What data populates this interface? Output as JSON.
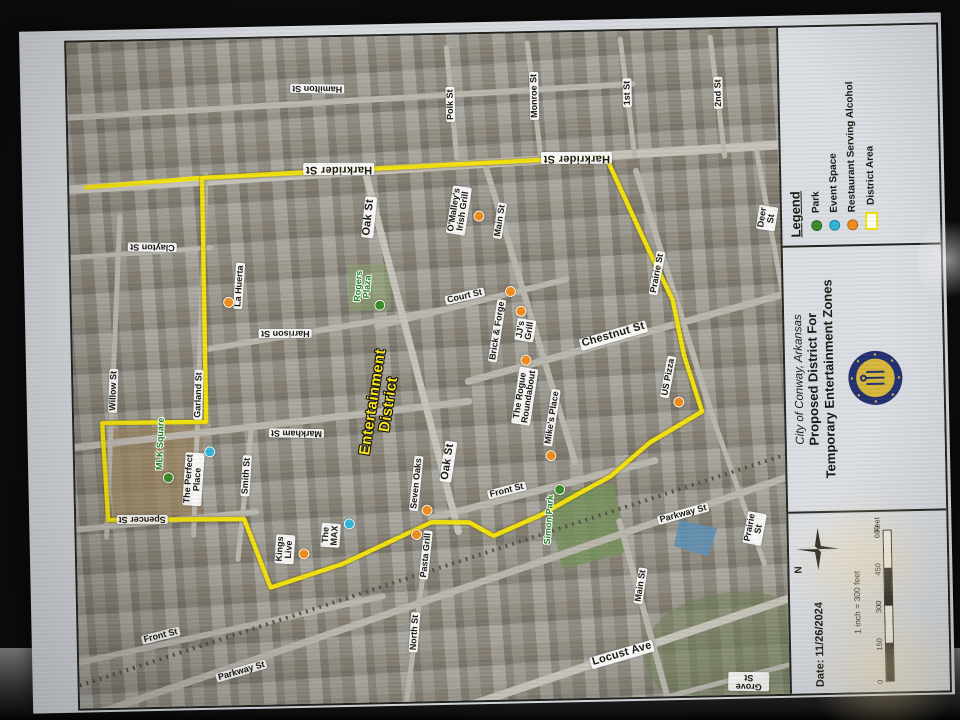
{
  "legend": {
    "title": "Legend",
    "items": [
      {
        "label": "Park",
        "swatch": "dot",
        "color": "#3a8b28"
      },
      {
        "label": "Event Space",
        "swatch": "dot",
        "color": "#2fb4d8"
      },
      {
        "label": "Restaurant Serving Alcohol",
        "swatch": "dot",
        "color": "#ef8c1a"
      },
      {
        "label": "District Area",
        "swatch": "box",
        "color": "#f3e20c"
      }
    ]
  },
  "title_block": {
    "city": "City of Conway, Arkansas",
    "line1": "Proposed District For",
    "line2": "Temporary Entertainment Zones"
  },
  "info_block": {
    "north_label": "N",
    "date": "Date: 11/26/2024",
    "scale_text": "1 inch = 300 feet",
    "scale_ticks": [
      "0",
      "150",
      "300",
      "450",
      "600"
    ],
    "scale_unit": "Feet"
  },
  "map": {
    "colors": {
      "boundary": "#f3e20c",
      "park": "#3a8b28",
      "event": "#2fb4d8",
      "restaurant": "#ef8c1a"
    },
    "district_label": {
      "t": "Entertainment\nDistrict",
      "x": 382,
      "y": 392,
      "r": -80
    },
    "district_polygon": [
      [
        208,
        163
      ],
      [
        612,
        150
      ],
      [
        652,
        242
      ],
      [
        676,
        295
      ],
      [
        686,
        350
      ],
      [
        703,
        407
      ],
      [
        650,
        437
      ],
      [
        610,
        470
      ],
      [
        575,
        488
      ],
      [
        540,
        507
      ],
      [
        492,
        527
      ],
      [
        468,
        513
      ],
      [
        430,
        512
      ],
      [
        340,
        552
      ],
      [
        268,
        574
      ],
      [
        243,
        505
      ],
      [
        107,
        503
      ],
      [
        103,
        406
      ],
      [
        207,
        407
      ]
    ],
    "district_stub": [
      [
        92,
        170
      ],
      [
        208,
        163
      ]
    ],
    "streets": [
      {
        "t": "Hamilton St",
        "x": 325,
        "y": 76,
        "r": 182
      },
      {
        "t": "Polk St",
        "x": 458,
        "y": 95,
        "r": -90
      },
      {
        "t": "Monroe St",
        "x": 542,
        "y": 88,
        "r": -90
      },
      {
        "t": "1st St",
        "x": 635,
        "y": 87,
        "r": -90
      },
      {
        "t": "2nd St",
        "x": 726,
        "y": 89,
        "r": -90
      },
      {
        "t": "Harkrider St",
        "x": 345,
        "y": 157,
        "r": 181,
        "big": true
      },
      {
        "t": "Harkrider St",
        "x": 583,
        "y": 151,
        "r": 181,
        "big": true
      },
      {
        "t": "Clayton St",
        "x": 157,
        "y": 231,
        "r": 182
      },
      {
        "t": "Oak St",
        "x": 374,
        "y": 206,
        "r": -83,
        "big": true
      },
      {
        "t": "Deer St",
        "x": 772,
        "y": 215,
        "r": -80
      },
      {
        "t": "Main St",
        "x": 505,
        "y": 212,
        "r": -80
      },
      {
        "t": "Prairie St",
        "x": 661,
        "y": 268,
        "r": -78
      },
      {
        "t": "Court St",
        "x": 468,
        "y": 287,
        "r": -12
      },
      {
        "t": "Harrison St",
        "x": 288,
        "y": 320,
        "r": 181
      },
      {
        "t": "Chestnut St",
        "x": 616,
        "y": 329,
        "r": -15,
        "big": true
      },
      {
        "t": "Willow St",
        "x": 115,
        "y": 374,
        "r": -87
      },
      {
        "t": "Garland St",
        "x": 200,
        "y": 380,
        "r": -87
      },
      {
        "t": "Markham St",
        "x": 297,
        "y": 420,
        "r": 182
      },
      {
        "t": "Oak St",
        "x": 448,
        "y": 452,
        "r": -80,
        "big": true
      },
      {
        "t": "Smith St",
        "x": 246,
        "y": 462,
        "r": -85
      },
      {
        "t": "Spencer St",
        "x": 141,
        "y": 503,
        "r": 181
      },
      {
        "t": "Front St",
        "x": 506,
        "y": 482,
        "r": -13
      },
      {
        "t": "Parkway St",
        "x": 682,
        "y": 509,
        "r": -14
      },
      {
        "t": "Prairie St",
        "x": 753,
        "y": 525,
        "r": -78
      },
      {
        "t": "Front St",
        "x": 157,
        "y": 620,
        "r": -13
      },
      {
        "t": "North St",
        "x": 411,
        "y": 622,
        "r": -85
      },
      {
        "t": "Main St",
        "x": 638,
        "y": 580,
        "r": -80
      },
      {
        "t": "Parkway St",
        "x": 237,
        "y": 657,
        "r": -15
      },
      {
        "t": "Locust Ave",
        "x": 618,
        "y": 648,
        "r": -15,
        "big": true
      },
      {
        "t": "Grove St",
        "x": 744,
        "y": 678,
        "r": 182
      }
    ],
    "pois": [
      {
        "t": "La Huerta",
        "x": 243,
        "y": 272,
        "r": -85,
        "c": "restaurant",
        "dx": 232,
        "dy": 288
      },
      {
        "t": "Rogers\nPlaza",
        "x": 367,
        "y": 275,
        "r": -85,
        "c": "park",
        "dx": 383,
        "dy": 294
      },
      {
        "t": "O'Malley's\nIrish Grill",
        "x": 464,
        "y": 201,
        "r": -80,
        "c": "restaurant",
        "dx": 484,
        "dy": 207
      },
      {
        "t": "Brick & Forge",
        "x": 500,
        "y": 322,
        "r": -80,
        "c": "restaurant",
        "dx": 514,
        "dy": 283
      },
      {
        "t": "JJ's\nGrill",
        "x": 528,
        "y": 322,
        "r": -80,
        "c": "restaurant",
        "dx": 524,
        "dy": 303
      },
      {
        "t": "The Rogue\nRoundabout",
        "x": 526,
        "y": 388,
        "r": -80,
        "c": "restaurant",
        "dx": 528,
        "dy": 352
      },
      {
        "t": "Mike's Place",
        "x": 553,
        "y": 410,
        "r": -80,
        "c": "restaurant",
        "dx": 551,
        "dy": 448
      },
      {
        "t": "US Pizza",
        "x": 670,
        "y": 372,
        "r": -78,
        "c": "restaurant",
        "dx": 680,
        "dy": 397
      },
      {
        "t": "MLK Square",
        "x": 161,
        "y": 428,
        "r": -87,
        "c": "park",
        "dx": 168,
        "dy": 462
      },
      {
        "t": "The Perfect\nPlace",
        "x": 193,
        "y": 464,
        "r": -85,
        "c": "event",
        "dx": 210,
        "dy": 437
      },
      {
        "t": "Kings\nLive",
        "x": 283,
        "y": 536,
        "r": -85,
        "c": "restaurant",
        "dx": 302,
        "dy": 541
      },
      {
        "t": "The\nMAX",
        "x": 329,
        "y": 523,
        "r": -85,
        "c": "event",
        "dx": 348,
        "dy": 512
      },
      {
        "t": "Seven Oaks",
        "x": 416,
        "y": 473,
        "r": -83,
        "c": "restaurant",
        "dx": 426,
        "dy": 500
      },
      {
        "t": "Pasta Grill",
        "x": 424,
        "y": 545,
        "r": -83,
        "c": "restaurant",
        "dx": 415,
        "dy": 524
      },
      {
        "t": "Simon Park",
        "x": 548,
        "y": 512,
        "r": -85,
        "c": "park",
        "dx": 559,
        "dy": 482
      }
    ]
  }
}
